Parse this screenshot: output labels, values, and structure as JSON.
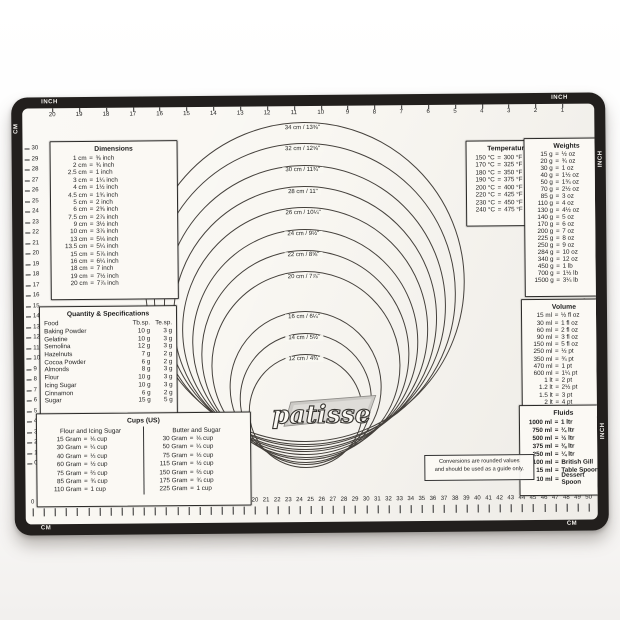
{
  "mat": {
    "brand": "patisse",
    "note_line1": "Conversions are rounded values",
    "note_line2": "and should be used as a guide only.",
    "border_color": "#221f1d",
    "surface_color": "#f9f7f2"
  },
  "rulers": {
    "top": {
      "unit_label": "INCH",
      "numbers": [
        20,
        19,
        18,
        17,
        16,
        15,
        14,
        13,
        12,
        11,
        10,
        9,
        8,
        7,
        6,
        5,
        4,
        3,
        2,
        1
      ]
    },
    "bottom": {
      "unit_label": "CM",
      "numbers": [
        0,
        1,
        2,
        3,
        4,
        5,
        6,
        7,
        8,
        9,
        10,
        11,
        12,
        13,
        14,
        15,
        16,
        17,
        18,
        19,
        20,
        21,
        22,
        23,
        24,
        25,
        26,
        27,
        28,
        29,
        30,
        31,
        32,
        33,
        34,
        35,
        36,
        37,
        38,
        39,
        40,
        41,
        42,
        43,
        44,
        45,
        46,
        47,
        48,
        49,
        50
      ]
    },
    "left": {
      "unit_label": "CM",
      "numbers": [
        30,
        29,
        28,
        27,
        26,
        25,
        24,
        23,
        22,
        21,
        20,
        19,
        18,
        17,
        16,
        15,
        14,
        13,
        12,
        11,
        10,
        9,
        8,
        7,
        6,
        5,
        4,
        3,
        2,
        1,
        0
      ]
    },
    "right": {
      "unit_label": "INCH",
      "numbers": [
        0,
        1,
        2,
        3,
        4,
        5,
        6,
        7,
        8,
        9,
        10,
        11,
        12
      ]
    }
  },
  "circles": {
    "items": [
      {
        "cm": 34,
        "label": "34 cm / 13⅜\""
      },
      {
        "cm": 32,
        "label": "32 cm / 12⅝\""
      },
      {
        "cm": 30,
        "label": "30 cm / 11¾\""
      },
      {
        "cm": 28,
        "label": "28 cm / 11\""
      },
      {
        "cm": 26,
        "label": "26 cm / 10¼\""
      },
      {
        "cm": 24,
        "label": "24 cm / 9½\""
      },
      {
        "cm": 22,
        "label": "22 cm / 8⅝\""
      },
      {
        "cm": 20,
        "label": "20 cm / 7⅞\""
      },
      {
        "cm": 16,
        "label": "16 cm / 6¼\""
      },
      {
        "cm": 14,
        "label": "14 cm / 5½\""
      },
      {
        "cm": 12,
        "label": "12 cm / 4¾\""
      }
    ]
  },
  "tables": {
    "dimensions": {
      "title": "Dimensions",
      "rows": [
        [
          "1 cm",
          "⅜ inch"
        ],
        [
          "2 cm",
          "¾ inch"
        ],
        [
          "2.5 cm",
          "1 inch"
        ],
        [
          "3 cm",
          "1¼ inch"
        ],
        [
          "4 cm",
          "1½ inch"
        ],
        [
          "4.5 cm",
          "1¾ inch"
        ],
        [
          "5 cm",
          "2 inch"
        ],
        [
          "6 cm",
          "2⅜ inch"
        ],
        [
          "7.5 cm",
          "2⅞ inch"
        ],
        [
          "9 cm",
          "3½ inch"
        ],
        [
          "10 cm",
          "3⅞ inch"
        ],
        [
          "13 cm",
          "5⅛ inch"
        ],
        [
          "13.5 cm",
          "5¼ inch"
        ],
        [
          "15 cm",
          "5⅞ inch"
        ],
        [
          "16 cm",
          "6¼ inch"
        ],
        [
          "18 cm",
          "7 inch"
        ],
        [
          "19 cm",
          "7½ inch"
        ],
        [
          "20 cm",
          "7⅞ inch"
        ]
      ]
    },
    "temperature": {
      "title": "Temperature",
      "rows": [
        [
          "150 °C",
          "300 °F"
        ],
        [
          "170 °C",
          "325 °F"
        ],
        [
          "180 °C",
          "350 °F"
        ],
        [
          "190 °C",
          "375 °F"
        ],
        [
          "200 °C",
          "400 °F"
        ],
        [
          "220 °C",
          "425 °F"
        ],
        [
          "230 °C",
          "450 °F"
        ],
        [
          "240 °C",
          "475 °F"
        ]
      ]
    },
    "weights": {
      "title": "Weights",
      "rows": [
        [
          "15 g",
          "½ oz"
        ],
        [
          "20 g",
          "¾ oz"
        ],
        [
          "30 g",
          "1 oz"
        ],
        [
          "40 g",
          "1½ oz"
        ],
        [
          "50 g",
          "1¾ oz"
        ],
        [
          "70 g",
          "2½ oz"
        ],
        [
          "85 g",
          "3 oz"
        ],
        [
          "110 g",
          "4 oz"
        ],
        [
          "130 g",
          "4½ oz"
        ],
        [
          "140 g",
          "5 oz"
        ],
        [
          "170 g",
          "6 oz"
        ],
        [
          "200 g",
          "7 oz"
        ],
        [
          "225 g",
          "8 oz"
        ],
        [
          "250 g",
          "9 oz"
        ],
        [
          "284 g",
          "10 oz"
        ],
        [
          "340 g",
          "12 oz"
        ],
        [
          "450 g",
          "1 lb"
        ],
        [
          "700 g",
          "1½ lb"
        ],
        [
          "1500 g",
          "3¼ lb"
        ]
      ]
    },
    "quantity": {
      "title": "Quantity & Specifications",
      "columns": [
        "Food",
        "Tb.sp.",
        "Te.sp."
      ],
      "rows": [
        [
          "Baking Powder",
          "10 g",
          "3 g"
        ],
        [
          "Gelatine",
          "10 g",
          "3 g"
        ],
        [
          "Semolina",
          "12 g",
          "3 g"
        ],
        [
          "Hazelnuts",
          "7 g",
          "2 g"
        ],
        [
          "Cocoa Powder",
          "6 g",
          "2 g"
        ],
        [
          "Almonds",
          "8 g",
          "3 g"
        ],
        [
          "Flour",
          "10 g",
          "3 g"
        ],
        [
          "Icing Sugar",
          "10 g",
          "3 g"
        ],
        [
          "Cinnamon",
          "6 g",
          "2 g"
        ],
        [
          "Sugar",
          "15 g",
          "5 g"
        ]
      ]
    },
    "volume": {
      "title": "Volume",
      "rows": [
        [
          "15 ml",
          "½ fl oz"
        ],
        [
          "30 ml",
          "1 fl oz"
        ],
        [
          "60 ml",
          "2 fl oz"
        ],
        [
          "90 ml",
          "3 fl oz"
        ],
        [
          "150 ml",
          "5 fl oz"
        ],
        [
          "250 ml",
          "½ pt"
        ],
        [
          "350 ml",
          "¾ pt"
        ],
        [
          "470 ml",
          "1 pt"
        ],
        [
          "600 ml",
          "1¼ pt"
        ],
        [
          "1 lt",
          "2 pt"
        ],
        [
          "1.2 lt",
          "2½ pt"
        ],
        [
          "1.5 lt",
          "3 pt"
        ],
        [
          "2 lt",
          "4 pt"
        ]
      ]
    },
    "cups": {
      "title": "Cups (US)",
      "left": {
        "header": "Flour and Icing Sugar",
        "rows": [
          [
            "15 Gram",
            "⅛ cup"
          ],
          [
            "30 Gram",
            "¼ cup"
          ],
          [
            "40 Gram",
            "⅓ cup"
          ],
          [
            "60 Gram",
            "½ cup"
          ],
          [
            "75 Gram",
            "⅔ cup"
          ],
          [
            "85 Gram",
            "¾ cup"
          ],
          [
            "110 Gram",
            "1 cup"
          ]
        ]
      },
      "right": {
        "header": "Butter and Sugar",
        "rows": [
          [
            "30 Gram",
            "⅛ cup"
          ],
          [
            "50 Gram",
            "¼ cup"
          ],
          [
            "75 Gram",
            "⅓ cup"
          ],
          [
            "115 Gram",
            "½ cup"
          ],
          [
            "150 Gram",
            "⅔ cup"
          ],
          [
            "175 Gram",
            "¾ cup"
          ],
          [
            "225 Gram",
            "1 cup"
          ]
        ]
      }
    },
    "fluids": {
      "title": "Fluids",
      "rows": [
        [
          "1000 ml",
          "1 ltr"
        ],
        [
          "750 ml",
          "¾ ltr"
        ],
        [
          "500 ml",
          "½ ltr"
        ],
        [
          "375 ml",
          "⅜ ltr"
        ],
        [
          "250 ml",
          "¼ ltr"
        ],
        [
          "100 ml",
          "British Gill"
        ],
        [
          "15 ml",
          "Table Spoon"
        ],
        [
          "10 ml",
          "Dessert Spoon"
        ]
      ]
    }
  }
}
